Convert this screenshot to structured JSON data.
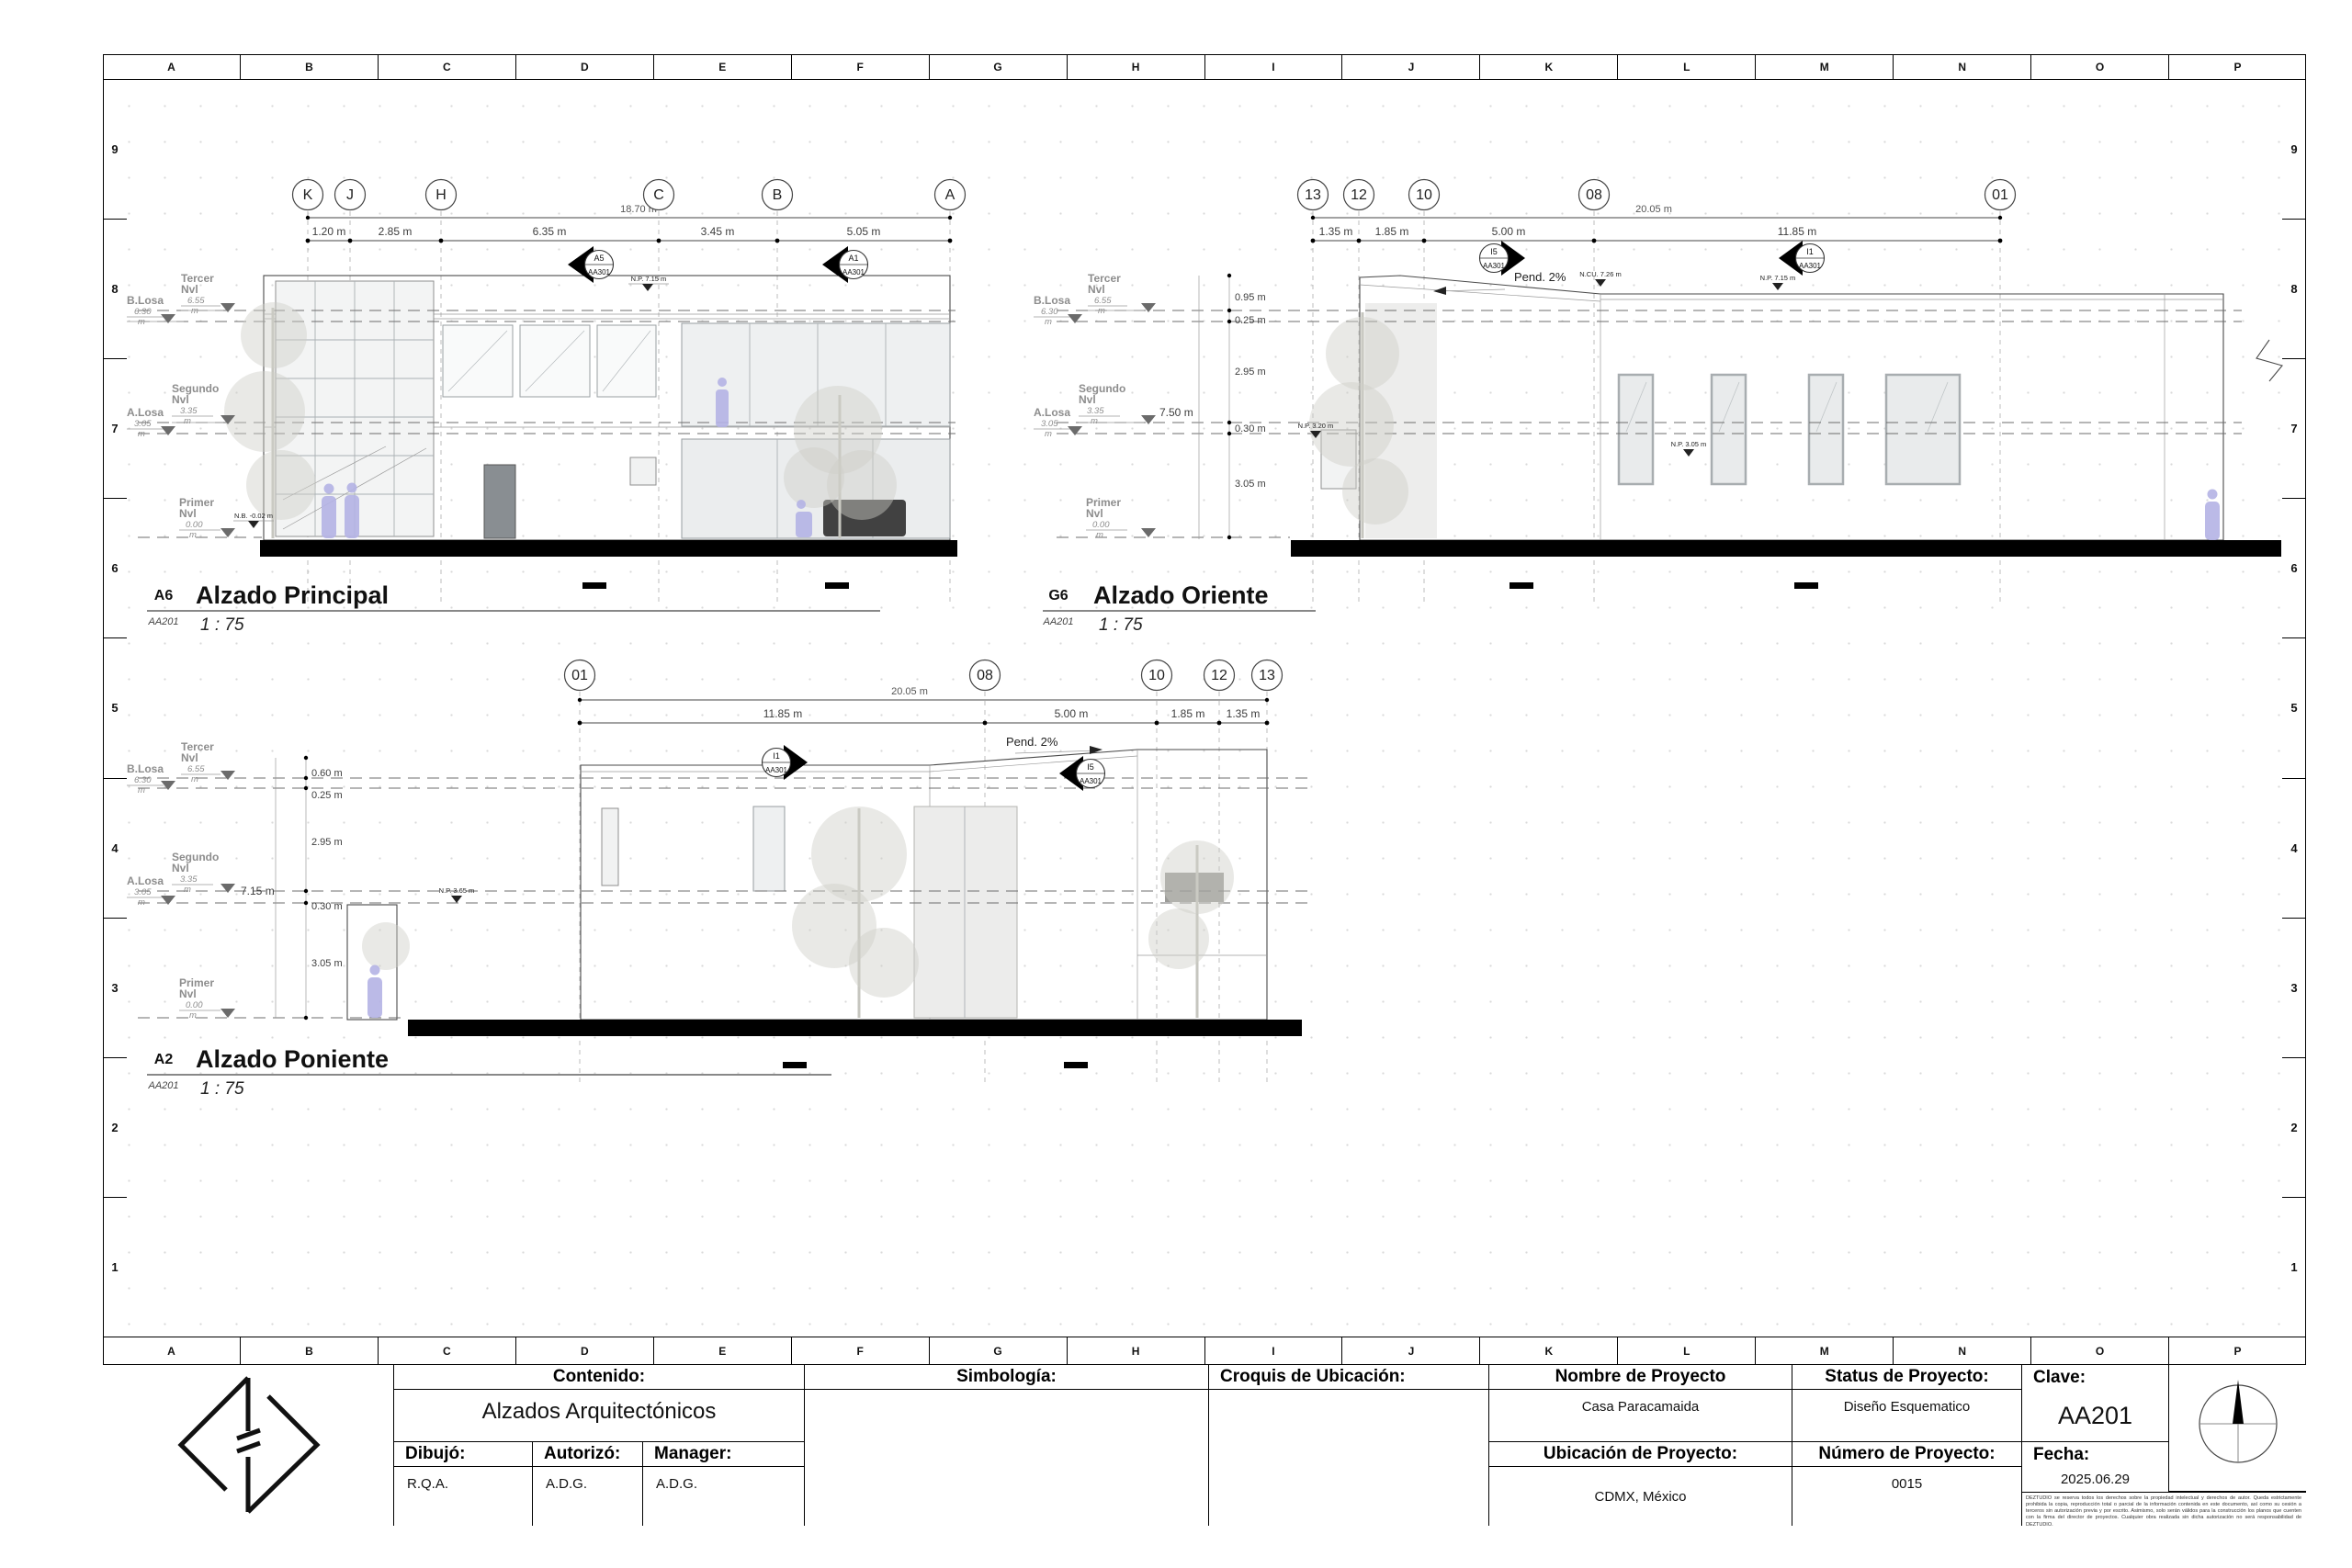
{
  "sheet": {
    "columns": [
      "A",
      "B",
      "C",
      "D",
      "E",
      "F",
      "G",
      "H",
      "I",
      "J",
      "K",
      "L",
      "M",
      "N",
      "O",
      "P"
    ],
    "rows": [
      "9",
      "8",
      "7",
      "6",
      "5",
      "4",
      "3",
      "2",
      "1"
    ]
  },
  "levels": {
    "tercer": {
      "line1": "Tercer",
      "line2": "Nvl",
      "value": "6.55",
      "unit": "m"
    },
    "b_losa": {
      "line1": "B.Losa",
      "value": "6.30",
      "unit": "m"
    },
    "segundo": {
      "line1": "Segundo",
      "line2": "Nvl",
      "value": "3.35",
      "unit": "m"
    },
    "a_losa": {
      "line1": "A.Losa",
      "value": "3.05",
      "unit": "m"
    },
    "primer": {
      "line1": "Primer",
      "line2": "Nvl",
      "value": "0.00",
      "unit": "m"
    }
  },
  "elevations": {
    "principal": {
      "ref": "A6",
      "sheet": "AA201",
      "title": "Alzado Principal",
      "scale": "1 : 75",
      "bubbles": [
        "K",
        "J",
        "H",
        "C",
        "B",
        "A"
      ],
      "total_dim": "18.70 m",
      "dims": [
        "1.20 m",
        "2.85 m",
        "6.35 m",
        "3.45 m",
        "5.05 m"
      ],
      "markers": [
        {
          "id": "A5",
          "sheet": "AA301"
        },
        {
          "id": "A1",
          "sheet": "AA301"
        }
      ],
      "spots": [
        "N.P. 7.15 m",
        "N.B. -0.02 m"
      ]
    },
    "oriente": {
      "ref": "G6",
      "sheet": "AA201",
      "title": "Alzado Oriente",
      "scale": "1 : 75",
      "bubbles": [
        "13",
        "12",
        "10",
        "08",
        "01"
      ],
      "total_dim": "20.05 m",
      "dims": [
        "1.35 m",
        "1.85 m",
        "5.00 m",
        "11.85 m"
      ],
      "vertical_dims": [
        "0.95 m",
        "0.25 m",
        "2.95 m",
        "0.30 m",
        "3.05 m"
      ],
      "height_dim": "7.50 m",
      "slope": "Pend. 2%",
      "markers": [
        {
          "id": "I5",
          "sheet": "AA301"
        },
        {
          "id": "I1",
          "sheet": "AA301"
        }
      ],
      "spots": [
        "N.CU. 7.26 m",
        "N.P. 7.15 m",
        "N.P. 3.20 m",
        "N.P. 3.05 m"
      ]
    },
    "poniente": {
      "ref": "A2",
      "sheet": "AA201",
      "title": "Alzado Poniente",
      "scale": "1 : 75",
      "bubbles": [
        "01",
        "08",
        "10",
        "12",
        "13"
      ],
      "total_dim": "20.05 m",
      "dims": [
        "11.85 m",
        "5.00 m",
        "1.85 m",
        "1.35 m"
      ],
      "vertical_dims": [
        "0.60 m",
        "0.25 m",
        "2.95 m",
        "0.30 m",
        "3.05 m"
      ],
      "height_dim": "7.15 m",
      "slope": "Pend. 2%",
      "markers": [
        {
          "id": "I1",
          "sheet": "AA301"
        },
        {
          "id": "I5",
          "sheet": "AA301"
        }
      ],
      "spots": [
        "N.P. 3.65 m"
      ]
    }
  },
  "title_block": {
    "contenido_label": "Contenido:",
    "contenido_value": "Alzados Arquitectónicos",
    "dibujo_label": "Dibujó:",
    "dibujo_value": "R.Q.A.",
    "autorizo_label": "Autorizó:",
    "autorizo_value": "A.D.G.",
    "manager_label": "Manager:",
    "manager_value": "A.D.G.",
    "simbologia_label": "Simbología:",
    "croquis_label": "Croquis de Ubicación:",
    "nombre_label": "Nombre de Proyecto",
    "nombre_value": "Casa Paracamaida",
    "status_label": "Status de Proyecto:",
    "status_value": "Diseño Esquematico",
    "clave_label": "Clave:",
    "clave_value": "AA201",
    "ubicacion_label": "Ubicación de Proyecto:",
    "ubicacion_value": "CDMX, México",
    "numero_label": "Número de Proyecto:",
    "numero_value": "0015",
    "fecha_label": "Fecha:",
    "fecha_value": "2025.06.29",
    "disclaimer": "DEZTUDIO se reserva todos los derechos sobre la propiedad intelectual y derechos de autor. Queda estrictamente prohibida la copia, reproducción total o parcial de la información contenida en este documento, así como su cesión a terceros sin autorización previa y por escrito. Asimismo, solo serán válidos para la construcción los planos que cuenten con la firma del director de proyectos. Cualquier obra realizada sin dicha autorización no será responsabilidad de DEZTUDIO."
  },
  "colors": {
    "figure_accent": "#b4b2e4",
    "ground": "#000000",
    "glass": "#eef0f1",
    "line": "#4a4a4a"
  }
}
